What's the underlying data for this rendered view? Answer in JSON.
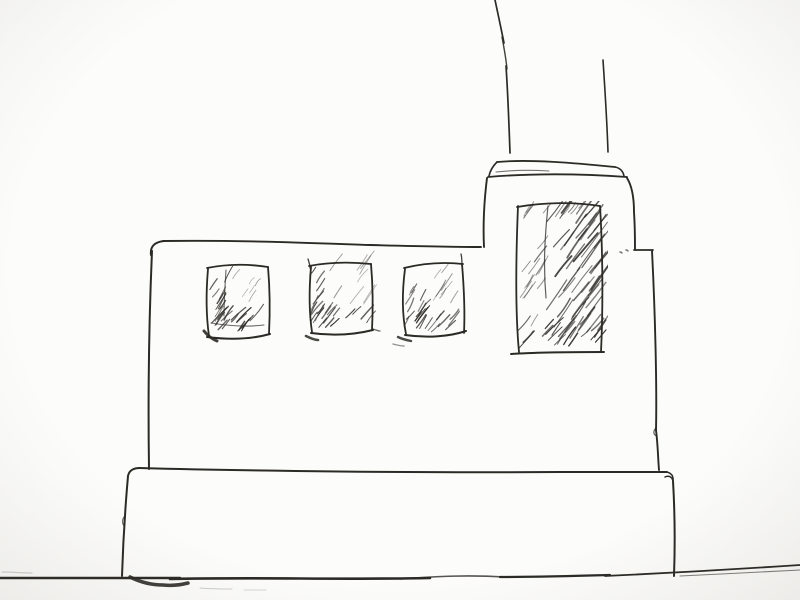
{
  "scene": {
    "title": "Hand-drawn ink sketch of a factory building",
    "description": "Freehand black ink sketch on off-white paper: a flat-roofed factory building with a stepped tower at right, a tall chimney rising off the top edge, three small hatched windows, one tall hatched tower window, a wide plinth base and a horizontal ground line.",
    "paper_color": "#fcfcfa",
    "paper_edge_color": "#edebe7",
    "ink_color": "#2c2a25",
    "canvas": {
      "width": 800,
      "height": 600
    }
  },
  "sketch": {
    "clips": [
      {
        "id": "clip-big-window",
        "x": 512,
        "y": 201,
        "w": 96,
        "h": 157
      }
    ],
    "strokes": [
      {
        "name": "ground-line-left",
        "d": "M 0,578 C 60,578 120,578 180,578",
        "w": 2.4
      },
      {
        "name": "ground-line-mid",
        "d": "M 170,579 C 260,577 340,580 430,578",
        "w": 2.6
      },
      {
        "name": "ground-line-overlap",
        "d": "M 400,579 C 440,576 470,575 505,577",
        "w": 1.6,
        "o": 0.8
      },
      {
        "name": "ground-line-right",
        "d": "M 500,577 C 540,577 575,576 610,575",
        "w": 2.2
      },
      {
        "name": "ground-line-far-right",
        "d": "M 605,576 C 670,573 740,569 800,565",
        "w": 1.8
      },
      {
        "name": "ground-line-double",
        "d": "M 680,576 C 720,574 765,572 800,570",
        "w": 1.1,
        "o": 0.6
      },
      {
        "name": "ground-smudge-left",
        "d": "M 2,572 C 12,572 22,573 32,573",
        "w": 1.2,
        "o": 0.2
      },
      {
        "name": "base-left-edge",
        "d": "M 128,476 C 125,510 123,545 122,576",
        "w": 2
      },
      {
        "name": "base-left-jog",
        "d": "M 124,517 C 122,520 122,523 124,526",
        "w": 1.2,
        "o": 0.7
      },
      {
        "name": "base-top-left-corner",
        "d": "M 128,476 C 129,471 133,468 140,468",
        "w": 1.9
      },
      {
        "name": "base-top-edge",
        "d": "M 139,468 C 250,471 420,473 560,472 C 600,472 640,472 667,472",
        "w": 2
      },
      {
        "name": "base-corner-curl",
        "d": "M 660,472 C 669,471 674,474 673,481 C 672,477 669,475 665,477",
        "w": 1.5
      },
      {
        "name": "base-right-edge",
        "d": "M 673,481 C 675,515 675,548 674,576",
        "w": 2
      },
      {
        "name": "base-foot-blob",
        "d": "M 130,577 C 140,582 152,585 163,585 C 172,586 180,585 188,583",
        "w": 3.5,
        "o": 0.9
      },
      {
        "name": "base-foot-smudge-1",
        "d": "M 200,588 C 212,589 222,589 232,589",
        "w": 1,
        "o": 0.22
      },
      {
        "name": "base-foot-smudge-2",
        "d": "M 244,590 C 252,590 258,590 266,590",
        "w": 1,
        "o": 0.18
      },
      {
        "name": "building-left-wall",
        "d": "M 152,251 C 149,320 148,400 149,469",
        "w": 2
      },
      {
        "name": "building-top-hook",
        "d": "M 151,255 C 150,247 154,242 164,241",
        "w": 2
      },
      {
        "name": "building-top-edge",
        "d": "M 163,241 C 240,240 310,243 370,245 C 410,246 450,247 481,247",
        "w": 1.9
      },
      {
        "name": "building-right-wall",
        "d": "M 652,251 C 655,310 657,385 656,430",
        "w": 1.9
      },
      {
        "name": "building-right-wall-low",
        "d": "M 656,430 C 658,446 658,459 659,470",
        "w": 1.9
      },
      {
        "name": "building-right-jog",
        "d": "M 656,428 C 653,431 653,435 657,436",
        "w": 1.2,
        "o": 0.8
      },
      {
        "name": "tower-left-edge",
        "d": "M 487,178 C 484,202 483,226 484,247",
        "w": 1.9
      },
      {
        "name": "tower-right-edge",
        "d": "M 627,178 C 632,186 634,199 634,212 C 635,227 635,240 635,249",
        "w": 1.9
      },
      {
        "name": "tower-step-top",
        "d": "M 634,250 C 640,250 647,250 653,250",
        "w": 1.8
      },
      {
        "name": "cap-top-edge",
        "d": "M 497,162 C 530,159 575,163 615,167",
        "w": 1.8
      },
      {
        "name": "cap-left-edge",
        "d": "M 497,162 C 493,166 490,171 489,176",
        "w": 1.6
      },
      {
        "name": "cap-right-edge",
        "d": "M 615,167 C 620,168 623,171 624,176",
        "w": 1.6
      },
      {
        "name": "cap-bottom-edge",
        "d": "M 488,177 C 535,173 585,174 627,177",
        "w": 1.8
      },
      {
        "name": "cap-inner-line",
        "d": "M 496,172 C 514,170 532,170 549,171",
        "w": 1.1,
        "o": 0.65
      },
      {
        "name": "chimney-left-line-upper",
        "d": "M 495,0 C 498,14 501,28 504,43",
        "w": 1.7
      },
      {
        "name": "chimney-left-line-mid",
        "d": "M 502,37 C 504,48 506,58 507,69",
        "w": 1.4,
        "o": 0.9
      },
      {
        "name": "chimney-left-line-lower",
        "d": "M 506,66 C 508,95 509,125 510,153",
        "w": 1.7
      },
      {
        "name": "chimney-right-line",
        "d": "M 603,60 C 605,90 607,122 608,152",
        "w": 1.6
      },
      {
        "name": "stray-dot-1",
        "d": "M 620,252 C 621,252 621,252 622,253",
        "w": 1.4,
        "o": 0.7
      },
      {
        "name": "stray-dot-2",
        "d": "M 626,250 C 627,250 627,250 628,251",
        "w": 1.4,
        "o": 0.7
      },
      {
        "name": "big-window-left-edge",
        "d": "M 518,206 C 516,255 515,310 519,352",
        "w": 1.8
      },
      {
        "name": "big-window-top-edge",
        "d": "M 517,207 C 545,202 575,202 600,206",
        "w": 1.8
      },
      {
        "name": "big-window-right-edge",
        "d": "M 600,206 C 603,255 603,310 601,352",
        "w": 1.8
      },
      {
        "name": "big-window-bottom-edge",
        "d": "M 511,354 C 540,352 575,352 604,352",
        "w": 1.9
      },
      {
        "name": "big-window-inner-line",
        "d": "M 548,206 C 545,235 543,264 546,298",
        "w": 1.2,
        "o": 0.75
      },
      {
        "name": "window1-left-edge",
        "d": "M 208,269 C 206,292 206,315 209,336",
        "w": 1.8
      },
      {
        "name": "window1-top-edge",
        "d": "M 207,268 C 227,264 249,264 268,267",
        "w": 1.8
      },
      {
        "name": "window1-right-edge",
        "d": "M 268,267 C 270,290 270,314 269,334",
        "w": 1.8
      },
      {
        "name": "window1-bottom-edge",
        "d": "M 207,337 C 230,340 252,339 270,334",
        "w": 2
      },
      {
        "name": "window1-inner-vertical",
        "d": "M 226,270 C 225,286 224,301 224,316",
        "w": 1.1,
        "o": 0.7
      },
      {
        "name": "window1-inner-horizontal",
        "d": "M 211,323 C 229,326 247,327 264,325",
        "w": 1.1,
        "o": 0.7
      },
      {
        "name": "window1-corner-blob",
        "d": "M 204,331 C 208,336 212,339 217,341",
        "w": 3,
        "o": 0.9
      },
      {
        "name": "window2-left-edge",
        "d": "M 311,267 C 309,290 309,312 312,332",
        "w": 1.8
      },
      {
        "name": "window2-top-edge",
        "d": "M 309,266 C 330,262 352,262 371,264",
        "w": 1.8
      },
      {
        "name": "window2-right-edge",
        "d": "M 371,264 C 373,287 373,310 372,330",
        "w": 1.8
      },
      {
        "name": "window2-bottom-edge",
        "d": "M 311,333 C 333,336 353,335 373,330",
        "w": 2
      },
      {
        "name": "window2-top-tick",
        "d": "M 308,259 C 309,262 310,265 310,268",
        "w": 1.3,
        "o": 0.9
      },
      {
        "name": "window2-corner-blob",
        "d": "M 306,336 C 310,338 314,340 318,340",
        "w": 2.6,
        "o": 0.85
      },
      {
        "name": "window2-bottom-tick",
        "d": "M 373,329 C 376,330 378,331 380,331",
        "w": 1.3,
        "o": 0.7
      },
      {
        "name": "window3-left-edge",
        "d": "M 405,269 C 402,292 402,314 406,334",
        "w": 1.8
      },
      {
        "name": "window3-top-edge",
        "d": "M 404,268 C 424,263 445,262 463,264",
        "w": 1.8
      },
      {
        "name": "window3-right-edge",
        "d": "M 462,264 C 464,288 465,312 464,333",
        "w": 1.8
      },
      {
        "name": "window3-right-tick",
        "d": "M 461,254 C 462,258 462,261 462,266",
        "w": 1.3,
        "o": 0.9
      },
      {
        "name": "window3-bottom-edge",
        "d": "M 405,335 C 426,338 448,337 466,331",
        "w": 2
      },
      {
        "name": "window3-corner-blob",
        "d": "M 398,337 C 402,339 406,340 411,341",
        "w": 2.4,
        "o": 0.85
      },
      {
        "name": "window3-under-mark",
        "d": "M 393,344 C 397,345 400,346 404,346",
        "w": 1.4,
        "o": 0.5
      }
    ],
    "hatch_regions": [
      {
        "name": "window1-hatch-left",
        "x": 206,
        "y": 274,
        "w": 22,
        "h": 56,
        "n": 13,
        "ang": 58,
        "jit": 16,
        "l0": 9,
        "l1": 19,
        "sw": 1.15,
        "op": 0.8,
        "seed": 11
      },
      {
        "name": "window1-hatch-bottom",
        "x": 208,
        "y": 319,
        "w": 56,
        "h": 15,
        "n": 15,
        "ang": 50,
        "jit": 18,
        "l0": 10,
        "l1": 22,
        "sw": 1.25,
        "op": 0.85,
        "seed": 12
      },
      {
        "name": "window1-hatch-upper-light",
        "x": 230,
        "y": 272,
        "w": 34,
        "h": 34,
        "n": 6,
        "ang": 56,
        "jit": 10,
        "l0": 8,
        "l1": 16,
        "sw": 0.85,
        "op": 0.45,
        "seed": 13
      },
      {
        "name": "window2-hatch-left",
        "x": 309,
        "y": 274,
        "w": 20,
        "h": 54,
        "n": 12,
        "ang": 58,
        "jit": 16,
        "l0": 9,
        "l1": 18,
        "sw": 1.1,
        "op": 0.75,
        "seed": 21
      },
      {
        "name": "window2-hatch-bottom",
        "x": 311,
        "y": 314,
        "w": 56,
        "h": 16,
        "n": 13,
        "ang": 50,
        "jit": 18,
        "l0": 10,
        "l1": 22,
        "sw": 1.2,
        "op": 0.85,
        "seed": 22
      },
      {
        "name": "window2-hatch-upper-light",
        "x": 326,
        "y": 268,
        "w": 42,
        "h": 38,
        "n": 9,
        "ang": 55,
        "jit": 10,
        "l0": 12,
        "l1": 26,
        "sw": 0.85,
        "op": 0.45,
        "seed": 23
      },
      {
        "name": "window3-hatch-left",
        "x": 402,
        "y": 274,
        "w": 20,
        "h": 56,
        "n": 12,
        "ang": 58,
        "jit": 16,
        "l0": 9,
        "l1": 18,
        "sw": 1.1,
        "op": 0.75,
        "seed": 31
      },
      {
        "name": "window3-hatch-bottom",
        "x": 405,
        "y": 315,
        "w": 52,
        "h": 17,
        "n": 12,
        "ang": 50,
        "jit": 18,
        "l0": 10,
        "l1": 22,
        "sw": 1.2,
        "op": 0.85,
        "seed": 32
      },
      {
        "name": "window3-hatch-upper-light",
        "x": 419,
        "y": 268,
        "w": 40,
        "h": 36,
        "n": 8,
        "ang": 55,
        "jit": 10,
        "l0": 10,
        "l1": 22,
        "sw": 0.85,
        "op": 0.45,
        "seed": 33
      },
      {
        "name": "big-window-hatch-left-column",
        "x": 519,
        "y": 218,
        "w": 20,
        "h": 112,
        "n": 14,
        "ang": 58,
        "jit": 14,
        "l0": 10,
        "l1": 22,
        "sw": 1.0,
        "op": 0.6,
        "seed": 41,
        "clip": "clip-big-window"
      },
      {
        "name": "big-window-hatch-main",
        "x": 546,
        "y": 210,
        "w": 52,
        "h": 135,
        "n": 30,
        "ang": 52,
        "jit": 10,
        "l0": 20,
        "l1": 45,
        "sw": 1.15,
        "op": 0.75,
        "seed": 42,
        "clip": "clip-big-window"
      },
      {
        "name": "big-window-hatch-upper-dark",
        "x": 552,
        "y": 212,
        "w": 42,
        "h": 66,
        "n": 13,
        "ang": 52,
        "jit": 8,
        "l0": 18,
        "l1": 42,
        "sw": 1.5,
        "op": 0.8,
        "seed": 43,
        "clip": "clip-big-window"
      },
      {
        "name": "big-window-hatch-lower-dark",
        "x": 556,
        "y": 282,
        "w": 40,
        "h": 56,
        "n": 10,
        "ang": 54,
        "jit": 8,
        "l0": 16,
        "l1": 38,
        "sw": 1.5,
        "op": 0.8,
        "seed": 44,
        "clip": "clip-big-window"
      },
      {
        "name": "big-window-hatch-bottom-band",
        "x": 516,
        "y": 328,
        "w": 84,
        "h": 22,
        "n": 18,
        "ang": 50,
        "jit": 14,
        "l0": 12,
        "l1": 26,
        "sw": 1.25,
        "op": 0.85,
        "seed": 45,
        "clip": "clip-big-window"
      },
      {
        "name": "big-window-hatch-top-band",
        "x": 520,
        "y": 205,
        "w": 66,
        "h": 12,
        "n": 7,
        "ang": 55,
        "jit": 12,
        "l0": 8,
        "l1": 18,
        "sw": 0.95,
        "op": 0.6,
        "seed": 46,
        "clip": "clip-big-window"
      }
    ]
  }
}
